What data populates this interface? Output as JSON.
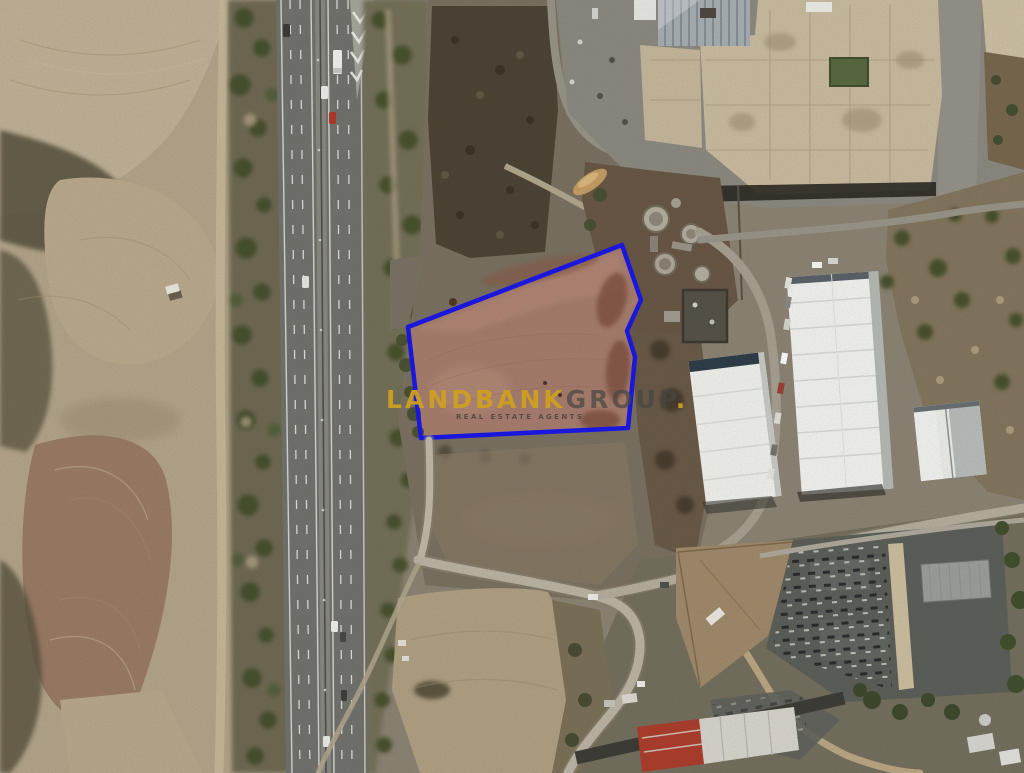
{
  "watermark": {
    "brand_primary": "LANDBANK",
    "brand_secondary": "GROUP",
    "brand_suffix": ".",
    "tagline": "REAL ESTATE AGENTS",
    "colors": {
      "primary_gold": "#CE9F21",
      "secondary_gray": "#464642"
    }
  },
  "map": {
    "type": "satellite-aerial-photo",
    "plot": {
      "boundary_color": "#1B18E8",
      "soil_color": "#A87E6E",
      "shape": "irregular-polygon"
    },
    "visible_features": [
      "plowed-farm-fields-west",
      "dual-carriageway-motorway",
      "tree-belts-along-motorway",
      "outlined-land-plot",
      "industrial-complex-north-east",
      "circular-treatment-tanks",
      "white-warehouses-east",
      "electrical-substation-south-east",
      "access-roads-south",
      "red-roof-building-south"
    ]
  }
}
